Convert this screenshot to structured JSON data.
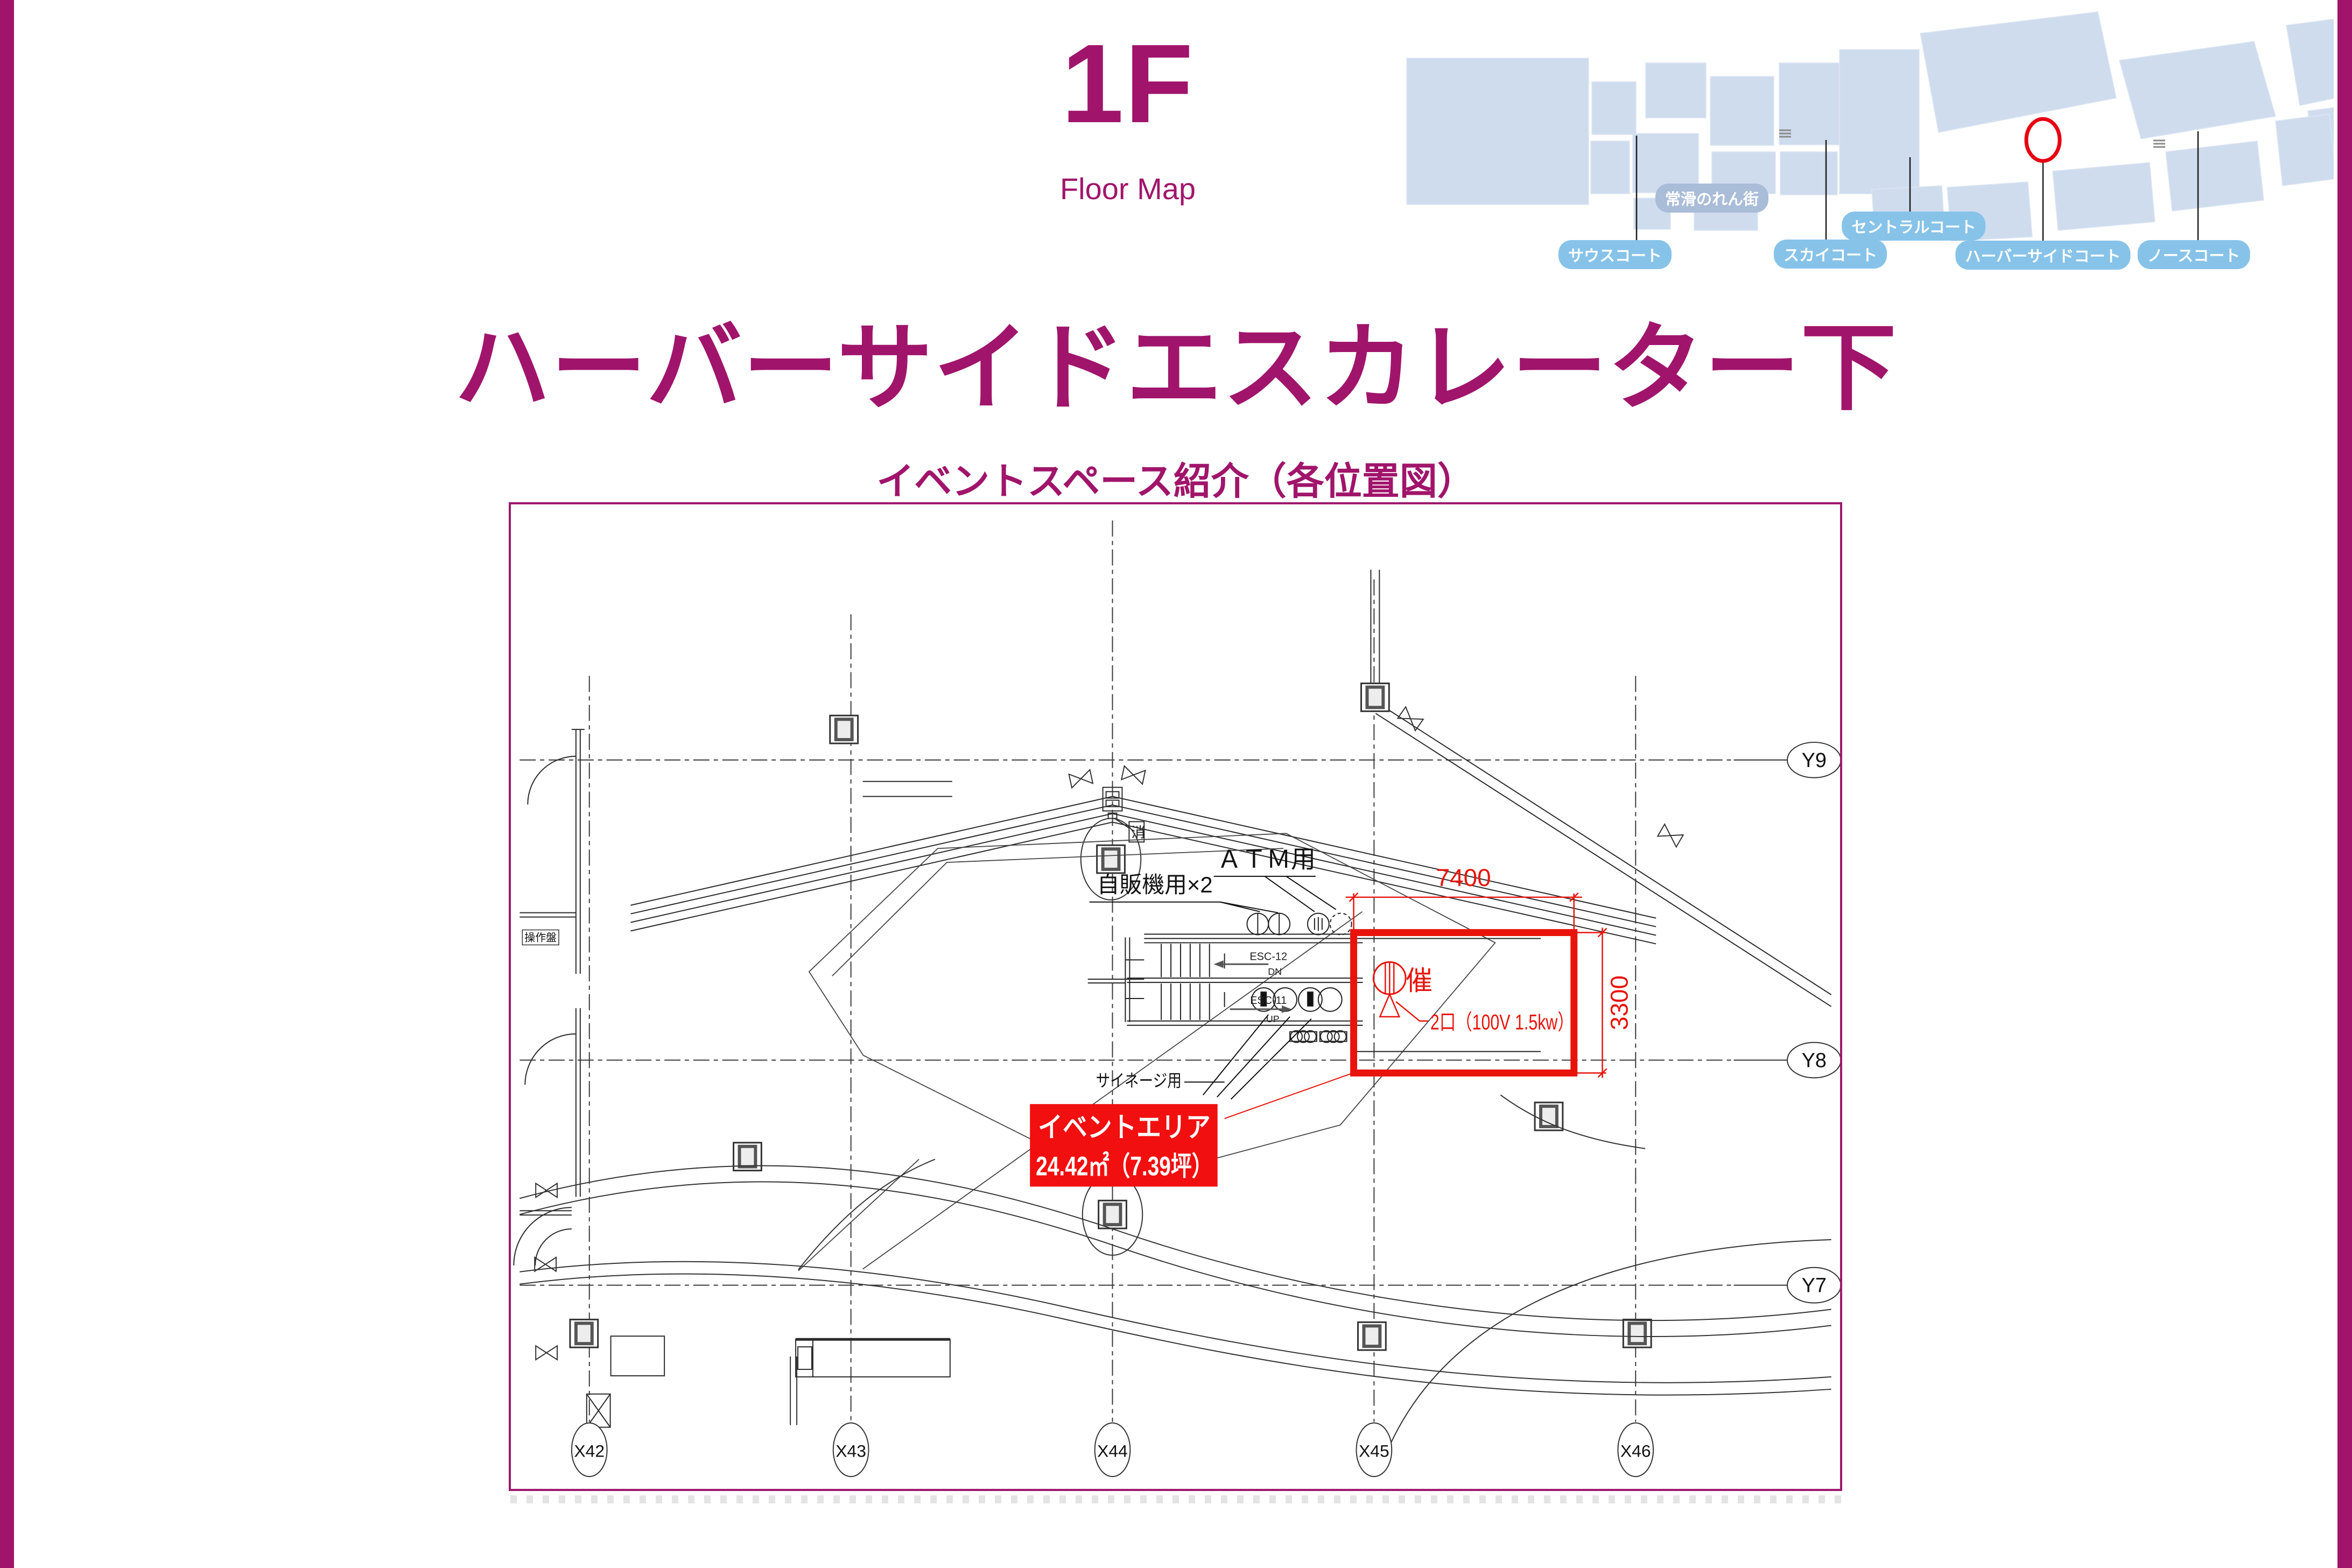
{
  "page": {
    "accent_magenta": "#a0156b",
    "annotation_red": "#e8140c",
    "event_label_red": "#f20f0f",
    "map_shape_blue": "#cfdcee",
    "map_pill_blue": "#87c3e9",
    "map_pill_gray_blue": "#a9bcd8"
  },
  "header": {
    "floor": "1F",
    "map_label": "Floor Map"
  },
  "title": {
    "heading": "ハーバーサイドエスカレーター下",
    "subheading": "イベントスペース紹介（各位置図）"
  },
  "minimap": {
    "noren_label": "常滑のれん街",
    "courts": [
      {
        "label": "サウスコート"
      },
      {
        "label": "スカイコート"
      },
      {
        "label": "セントラルコート"
      },
      {
        "label": "ハーバーサイドコート"
      },
      {
        "label": "ノースコート"
      }
    ],
    "marker": "red-circle-on-harborside-court"
  },
  "drawing": {
    "grid": {
      "x_labels": [
        "X42",
        "X43",
        "X44",
        "X45",
        "X46"
      ],
      "y_labels": [
        "Y9",
        "Y8",
        "Y7"
      ]
    },
    "labels": {
      "atm": "ＡＴＭ用",
      "vending": "自販機用×2",
      "signage": "サイネージ用",
      "control_panel": "操作盤",
      "fire": "消",
      "esc_down_id": "ESC-12",
      "esc_down_dir": "DN",
      "esc_up_id": "ESC-11",
      "esc_up_dir": "UP"
    },
    "annotations": {
      "width_dim": "7400",
      "height_dim": "3300",
      "outlet": "2口（100V 1.5kw）",
      "event_mark": "催"
    },
    "event_area": {
      "title": "イベントエリア",
      "size": "24.42㎡（7.39坪）"
    }
  }
}
